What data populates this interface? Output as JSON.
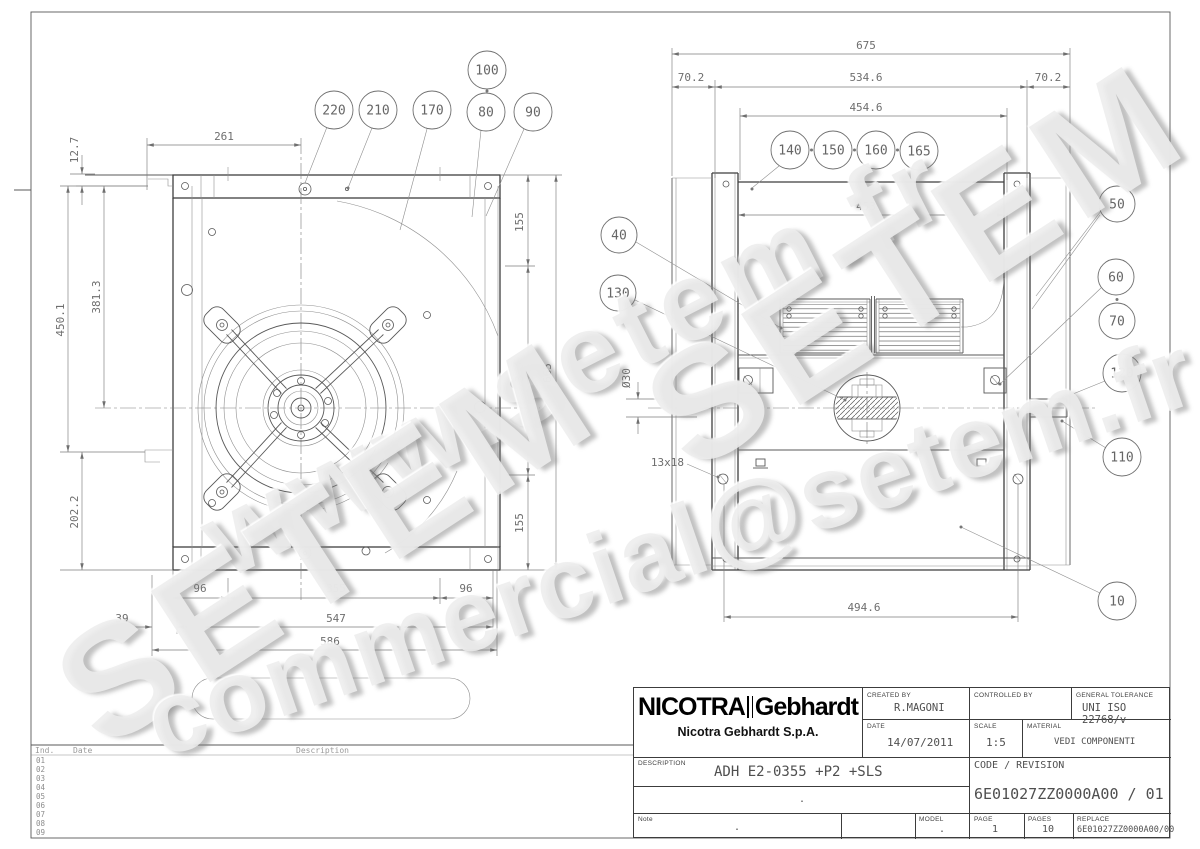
{
  "watermarks": {
    "site": "www.setem.fr",
    "brand": "SETEM",
    "email": "commercial@setem.fr"
  },
  "left_view": {
    "balloons": {
      "b220": "220",
      "b210": "210",
      "b170": "170",
      "b100": "100",
      "b80": "80",
      "b90": "90"
    },
    "dims": {
      "d12_7": "12.7",
      "d261": "261",
      "d450_1": "450.1",
      "d381_3": "381.3",
      "d202_2": "202.2",
      "d96l": "96",
      "d355b": "355",
      "d96r": "96",
      "d39": "39",
      "d547": "547",
      "d586": "586",
      "d155t": "155",
      "d355r": "355",
      "d155b": "155",
      "d665": "665"
    }
  },
  "right_view": {
    "balloons": {
      "b140": "140",
      "b150": "150",
      "b160": "160",
      "b165": "165",
      "b40": "40",
      "b130": "130",
      "b50": "50",
      "b60": "60",
      "b70": "70",
      "b120": "120",
      "b110": "110",
      "b10": "10"
    },
    "dims": {
      "d675": "675",
      "d70_2l": "70.2",
      "d534_6": "534.6",
      "d70_2r": "70.2",
      "d454_6": "454.6",
      "d453": "453",
      "d494_6": "494.6",
      "d30": "Ø30",
      "d13x18": "13x18"
    }
  },
  "revision_table": {
    "headers": {
      "ind": "Ind.",
      "date": "Date",
      "desc": "Description"
    },
    "rows": [
      "01",
      "02",
      "03",
      "04",
      "05",
      "06",
      "07",
      "08",
      "09"
    ]
  },
  "title_block": {
    "logo_primary": "NICOTRA",
    "logo_secondary": "Gebhardt",
    "company": "Nicotra Gebhardt S.p.A.",
    "created_by_label": "CREATED BY",
    "created_by": "R.MAGONI",
    "controlled_by_label": "CONTROLLED BY",
    "controlled_by": "",
    "tolerance_label": "GENERAL TOLERANCE",
    "tolerance": "UNI ISO 22768/v",
    "date_label": "DATE",
    "date": "14/07/2011",
    "scale_label": "SCALE",
    "scale": "1:5",
    "material_label": "MATERIAL",
    "material": "VEDI COMPONENTI",
    "description_label": "DESCRIPTION",
    "description": "ADH E2-0355 +P2 +SLS",
    "description2": ".",
    "code_label": "CODE / REVISION",
    "code": "6E01027ZZ0000A00 / 01",
    "note_label": "Note",
    "note": ".",
    "model_label": "MODEL",
    "model": ".",
    "page_label": "PAGE",
    "page": "1",
    "pages_label": "PAGES",
    "pages": "10",
    "replace_label": "REPLACE",
    "replace": "6E01027ZZ0000A00/00"
  }
}
